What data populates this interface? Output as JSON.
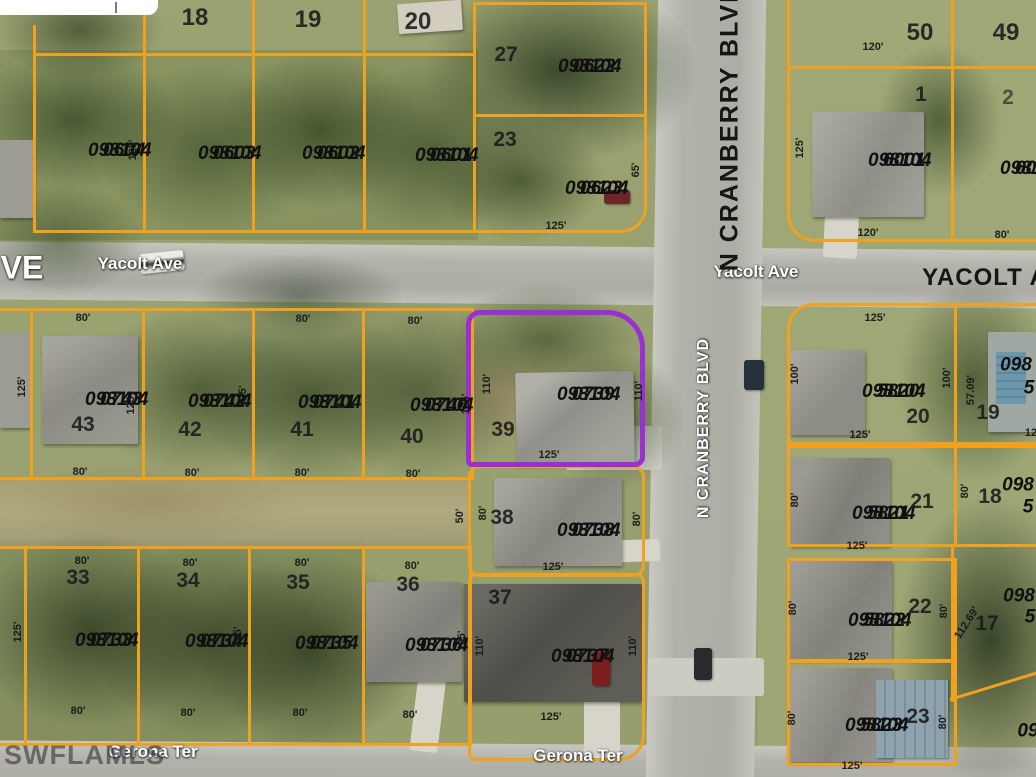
{
  "watermark": "SWFLAMLS",
  "streets": {
    "left_partial": "VE",
    "yacolt_west": "Yacolt Ave",
    "yacolt_east": "Yacolt Ave",
    "yacolt_far_east": "YACOLT A",
    "cranberry_top": "N CRANBERRY BLVD",
    "cranberry_mid": "N CRANBERRY BLVD",
    "gerona_west": "Gerona Ter",
    "gerona_east": "Gerona Ter"
  },
  "highlight": {
    "apn": "098104 0739",
    "lot": "39",
    "color": "#9a2fd4"
  },
  "colors": {
    "boundary": "#f0a11e",
    "highlight": "#9a2fd4"
  },
  "apns": [
    {
      "l1": "098104",
      "l2": "0604"
    },
    {
      "l1": "098104",
      "l2": "0603"
    },
    {
      "l1": "098104",
      "l2": "0602"
    },
    {
      "l1": "098104",
      "l2": "0601"
    },
    {
      "l1": "098104",
      "l2": "0622"
    },
    {
      "l1": "098104",
      "l2": "0623"
    },
    {
      "l1": "098104",
      "l2": "6001"
    },
    {
      "l1": "098104",
      "l2": "6002"
    },
    {
      "l1": "098104",
      "l2": "0743"
    },
    {
      "l1": "098104",
      "l2": "0742"
    },
    {
      "l1": "098104",
      "l2": "0741"
    },
    {
      "l1": "098104",
      "l2": "0740"
    },
    {
      "l1": "098104",
      "l2": "0739"
    },
    {
      "l1": "098104",
      "l2": "5820"
    },
    {
      "l1": "098104",
      "l2": "0738"
    },
    {
      "l1": "098104",
      "l2": "5821"
    },
    {
      "l1": "098104",
      "l2": "0733"
    },
    {
      "l1": "098104",
      "l2": "0734"
    },
    {
      "l1": "098104",
      "l2": "0735"
    },
    {
      "l1": "098104",
      "l2": "0736"
    },
    {
      "l1": "098104",
      "l2": "0737"
    },
    {
      "l1": "098104",
      "l2": "5822"
    },
    {
      "l1": "098104",
      "l2": "5823"
    }
  ],
  "apn_fragments": [
    {
      "l1": "098",
      "l2": "5"
    },
    {
      "l1": "098",
      "l2": "5"
    },
    {
      "l1": "098",
      "l2": "5"
    },
    {
      "l1": "09",
      "l2": ""
    }
  ],
  "lots": [
    "18",
    "19",
    "20",
    "27",
    "23",
    "50",
    "49",
    "1",
    "2",
    "43",
    "42",
    "41",
    "40",
    "39",
    "20",
    "19",
    "38",
    "21",
    "18",
    "33",
    "34",
    "35",
    "36",
    "37",
    "22",
    "17",
    "23"
  ],
  "dims": [
    "125'",
    "120'",
    "65'",
    "125'",
    "125'",
    "120'",
    "80'",
    "80'",
    "80'",
    "80'",
    "80'",
    "80'",
    "80'",
    "80'",
    "125'",
    "125'",
    "125'",
    "110'",
    "125'",
    "125'",
    "110'",
    "125'",
    "100'",
    "100'",
    "125'",
    "57.09'",
    "80'",
    "125'",
    "80'",
    "50'",
    "80'",
    "80'",
    "125'",
    "80'",
    "80'",
    "80'",
    "80'",
    "125'",
    "125'",
    "125'",
    "110'",
    "110'",
    "80'",
    "80'",
    "80'",
    "80'",
    "125'",
    "80'",
    "80'",
    "125'",
    "112.69'",
    "80'",
    "80'",
    "125'",
    "12"
  ]
}
